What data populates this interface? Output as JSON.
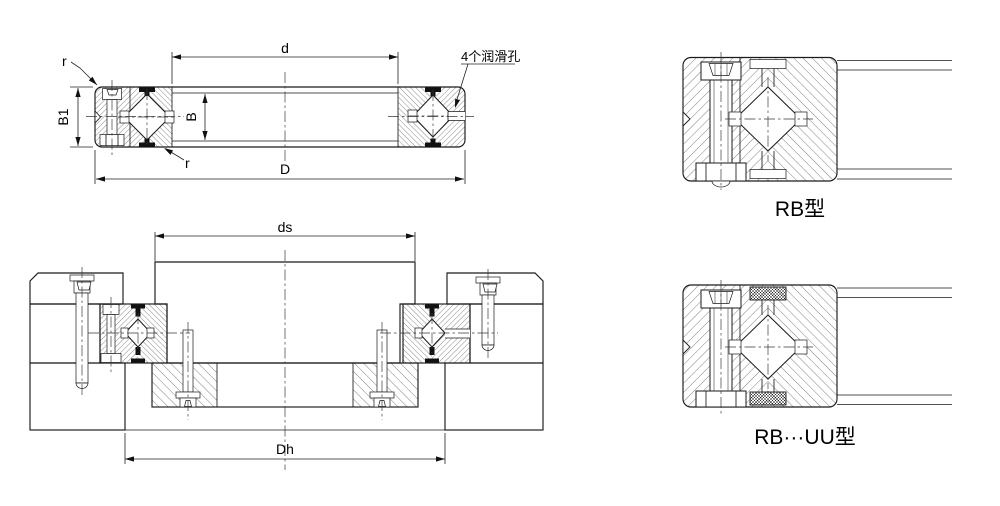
{
  "colors": {
    "background": "#ffffff",
    "line": "#1a1a1a"
  },
  "main_view": {
    "dim_bore": "d",
    "dim_outer": "D",
    "dim_width": "B",
    "dim_width1": "B1",
    "radius_top": "r",
    "radius_bottom": "r",
    "lube_note": "4个润滑孔"
  },
  "mounting_view": {
    "dim_shaft_seat": "ds",
    "dim_housing_bore": "Dh"
  },
  "detail_views": {
    "rb_label": "RB型",
    "rbuu_label": "RB···UU型"
  }
}
